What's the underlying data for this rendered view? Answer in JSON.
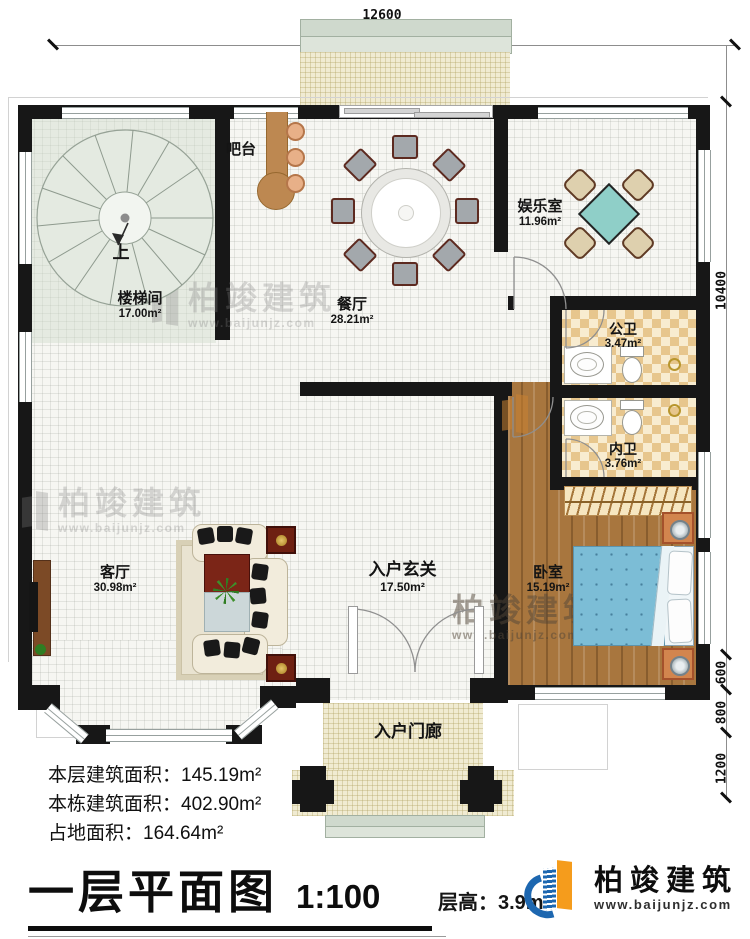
{
  "dims": {
    "top": "12600",
    "right": [
      "10400",
      "600",
      "800",
      "1200"
    ]
  },
  "rooms": {
    "stairwell": {
      "name": "楼梯间",
      "area": "17.00m²"
    },
    "bar": {
      "name": "吧台"
    },
    "dining": {
      "name": "餐厅",
      "area": "28.21m²"
    },
    "entertainment": {
      "name": "娱乐室",
      "area": "11.96m²"
    },
    "public_bath": {
      "name": "公卫",
      "area": "3.47m²"
    },
    "inner_bath": {
      "name": "内卫",
      "area": "3.76m²"
    },
    "living": {
      "name": "客厅",
      "area": "30.98m²"
    },
    "foyer": {
      "name": "入户玄关",
      "area": "17.50m²"
    },
    "bedroom": {
      "name": "卧室",
      "area": "15.19m²"
    },
    "porch": {
      "name": "入户门廊"
    }
  },
  "stair_direction": "上",
  "stats": {
    "line1_label": "本层建筑面积：",
    "line1_value": "145.19m²",
    "line2_label": "本栋建筑面积：",
    "line2_value": "402.90m²",
    "line3_label": "占地面积：",
    "line3_value": "164.64m²"
  },
  "title": {
    "text": "一层平面图",
    "scale": "1:100",
    "floor_height": "层高：3.9m"
  },
  "brand": {
    "name": "柏竣建筑",
    "url": "www.baijunjz.com",
    "blue": "#1d67b0",
    "orange": "#f59c1c"
  }
}
